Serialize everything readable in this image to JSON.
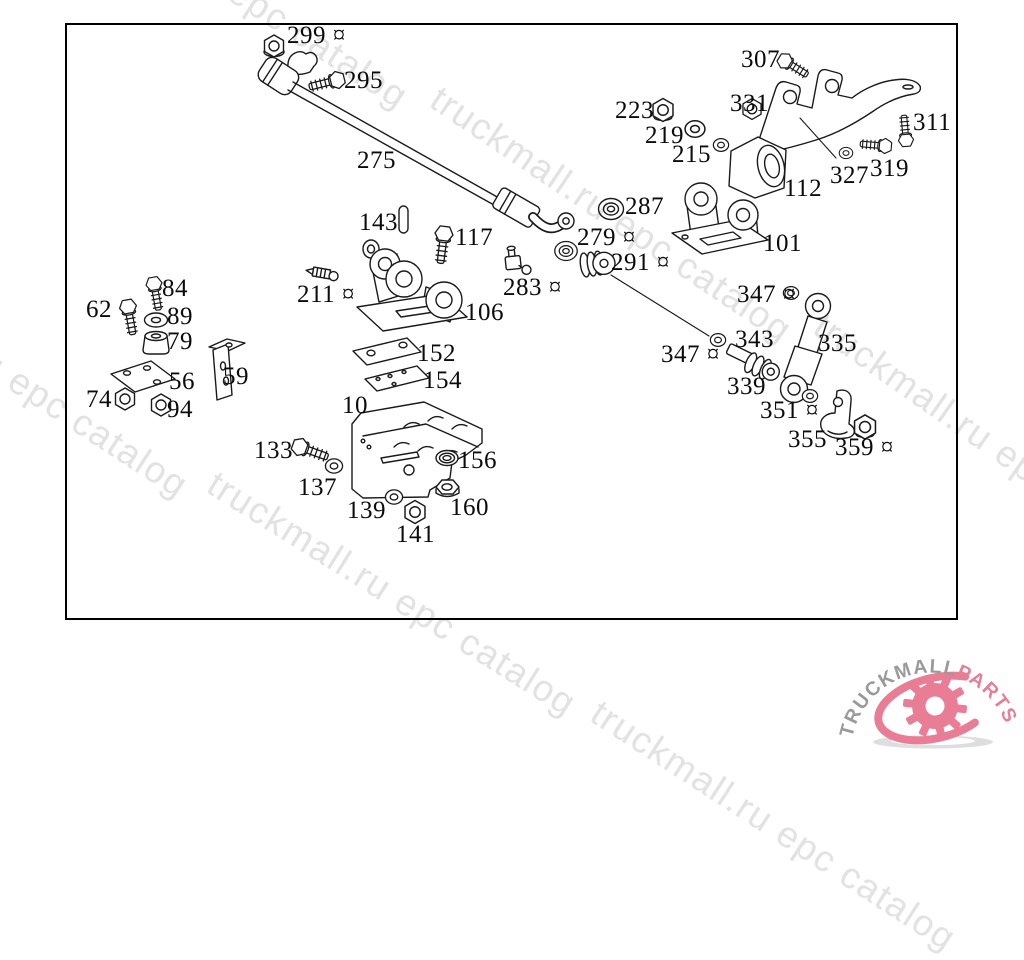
{
  "watermark": {
    "text": "truckmall.ru epc catalog",
    "color": "#e2e2e2",
    "instances": [
      {
        "t": "truckmall.ru epc catalog",
        "x": 58,
        "y": -150,
        "rot": 33
      },
      {
        "t": "truckmall.ru epc catalog",
        "x": 446,
        "y": 78,
        "rot": 34
      },
      {
        "t": "truckmall.ru epc catalog",
        "x": -162,
        "y": 239,
        "rot": 33
      },
      {
        "t": "truckmall.ru epc catalog",
        "x": 222,
        "y": 463,
        "rot": 32
      },
      {
        "t": "truckmall.ru epc catalog",
        "x": 830,
        "y": 305,
        "rot": 35
      },
      {
        "t": "truckmall.ru epc catalog",
        "x": 606,
        "y": 692,
        "rot": 33
      }
    ]
  },
  "logo": {
    "brand": "TRUCKMALL",
    "suffix": "PARTS",
    "brand_color": "#9a9a9a",
    "accent_color": "#e87d95"
  },
  "diagram": {
    "note_symbol": "¤",
    "line_color": "#1a1a1a",
    "labels": [
      {
        "t": "299 ¤",
        "x": 287,
        "y": 23
      },
      {
        "t": "295",
        "x": 344,
        "y": 68
      },
      {
        "t": "275",
        "x": 357,
        "y": 148
      },
      {
        "t": "143",
        "x": 359,
        "y": 210
      },
      {
        "t": "117",
        "x": 455,
        "y": 225
      },
      {
        "t": "211 ¤",
        "x": 297,
        "y": 282
      },
      {
        "t": "106",
        "x": 465,
        "y": 300
      },
      {
        "t": "152",
        "x": 417,
        "y": 341
      },
      {
        "t": "154",
        "x": 423,
        "y": 368
      },
      {
        "t": "10",
        "x": 342,
        "y": 393
      },
      {
        "t": "133",
        "x": 254,
        "y": 438
      },
      {
        "t": "137",
        "x": 298,
        "y": 475
      },
      {
        "t": "139",
        "x": 347,
        "y": 498
      },
      {
        "t": "141",
        "x": 396,
        "y": 522
      },
      {
        "t": "156",
        "x": 458,
        "y": 448
      },
      {
        "t": "160",
        "x": 450,
        "y": 495
      },
      {
        "t": "62",
        "x": 86,
        "y": 297
      },
      {
        "t": "84",
        "x": 162,
        "y": 276
      },
      {
        "t": "89",
        "x": 167,
        "y": 304
      },
      {
        "t": "79",
        "x": 167,
        "y": 329
      },
      {
        "t": "56",
        "x": 169,
        "y": 369
      },
      {
        "t": "59",
        "x": 223,
        "y": 364
      },
      {
        "t": "74",
        "x": 86,
        "y": 387
      },
      {
        "t": "94",
        "x": 167,
        "y": 397
      },
      {
        "t": "223",
        "x": 615,
        "y": 98
      },
      {
        "t": "219",
        "x": 645,
        "y": 123
      },
      {
        "t": "215",
        "x": 672,
        "y": 142
      },
      {
        "t": "331",
        "x": 730,
        "y": 91
      },
      {
        "t": "307",
        "x": 741,
        "y": 47
      },
      {
        "t": "311",
        "x": 913,
        "y": 110
      },
      {
        "t": "327",
        "x": 830,
        "y": 163
      },
      {
        "t": "319",
        "x": 870,
        "y": 156
      },
      {
        "t": "112",
        "x": 784,
        "y": 176
      },
      {
        "t": "287",
        "x": 625,
        "y": 194
      },
      {
        "t": "279 ¤",
        "x": 577,
        "y": 225
      },
      {
        "t": "283 ¤",
        "x": 503,
        "y": 275
      },
      {
        "t": "291 ¤",
        "x": 611,
        "y": 250
      },
      {
        "t": "101",
        "x": 763,
        "y": 231
      },
      {
        "t": "347 ¤",
        "x": 737,
        "y": 282
      },
      {
        "t": "347 ¤",
        "x": 661,
        "y": 342
      },
      {
        "t": "343",
        "x": 735,
        "y": 327
      },
      {
        "t": "339",
        "x": 727,
        "y": 374
      },
      {
        "t": "335",
        "x": 818,
        "y": 331
      },
      {
        "t": "351 ¤",
        "x": 760,
        "y": 398
      },
      {
        "t": "355",
        "x": 788,
        "y": 427
      },
      {
        "t": "359 ¤",
        "x": 835,
        "y": 435
      }
    ]
  }
}
